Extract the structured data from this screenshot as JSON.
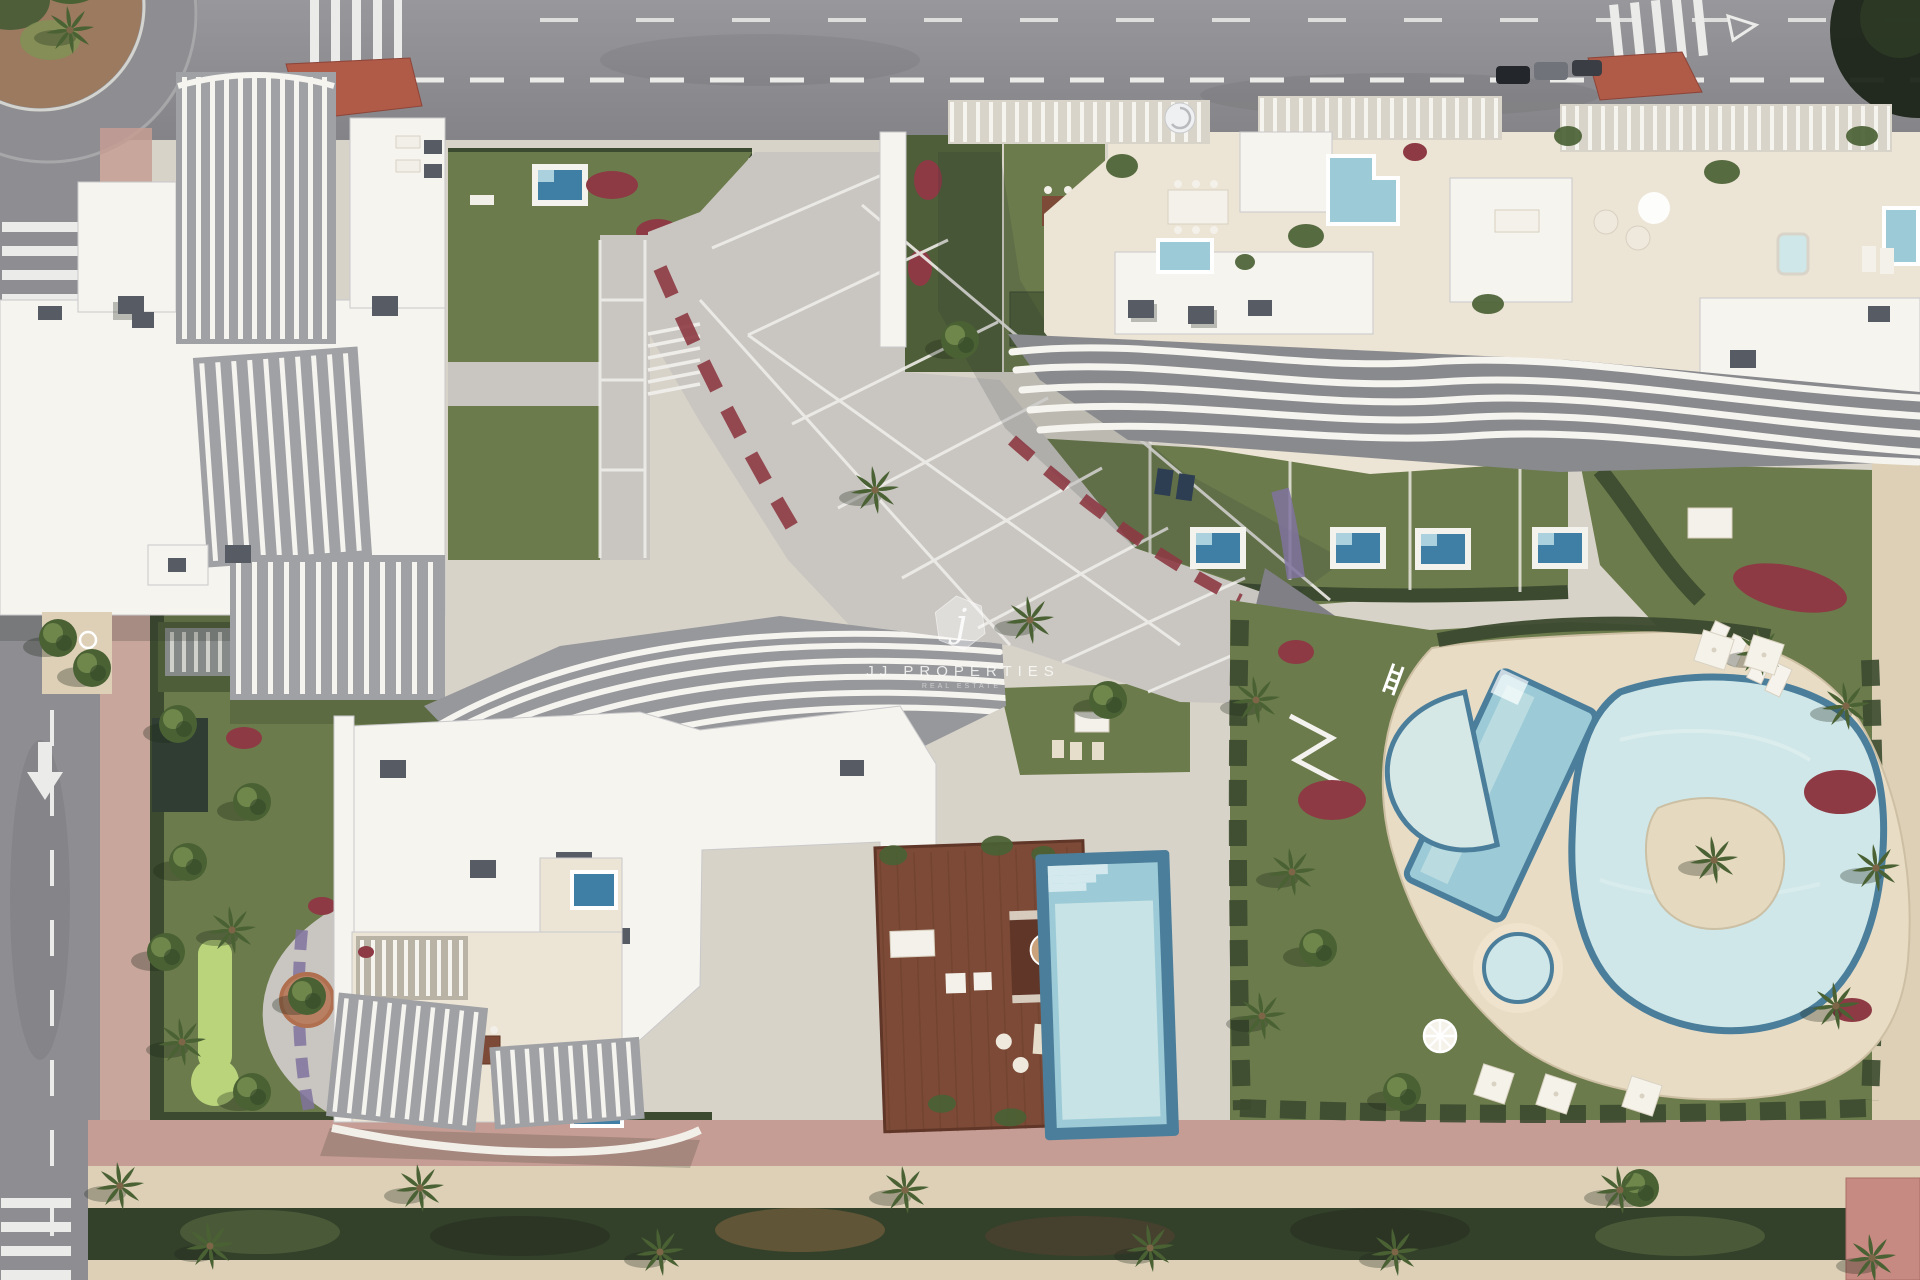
{
  "watermark": {
    "logo_letter": "j",
    "title": "JJ PROPERTIES",
    "subtitle": "REAL ESTATE"
  },
  "palette": {
    "asphalt": "#8e8e92",
    "marking": "#ebebe9",
    "sidewalkPink": "#c59d94",
    "paving": "#d8d3c9",
    "plaza": "#c9c6c1",
    "plazaLine": "#efede9",
    "building": "#f6f4ef",
    "buildingEdge": "#c9c9cb",
    "louverBase": "#9fa1a5",
    "cream": "#ece4d4",
    "roofBox": "#575c64",
    "lawn": "#6b7b4b",
    "lawnDark": "#4e5e39",
    "hedge": "#3c4a2f",
    "putting": "#b9d47b",
    "treeGreen": "#4a6134",
    "treeLight": "#7e9454",
    "redFlower": "#8d3a44",
    "purpleFlower": "#80739f",
    "terracotta": "#b97f63",
    "poolLight": "#cfe7e8",
    "poolMid": "#9ccbd7",
    "poolDark": "#4b7e9b",
    "plunge": "#3f7fa6",
    "deck": "#7c4a36",
    "deckDark": "#5f3627",
    "sand": "#ddd0b7",
    "deckSand": "#e8dcc5",
    "island": "#e5d9bf",
    "shadow": "#2c3328",
    "redIsland": "#b05a48",
    "pinkRoof": "#c68a82"
  }
}
